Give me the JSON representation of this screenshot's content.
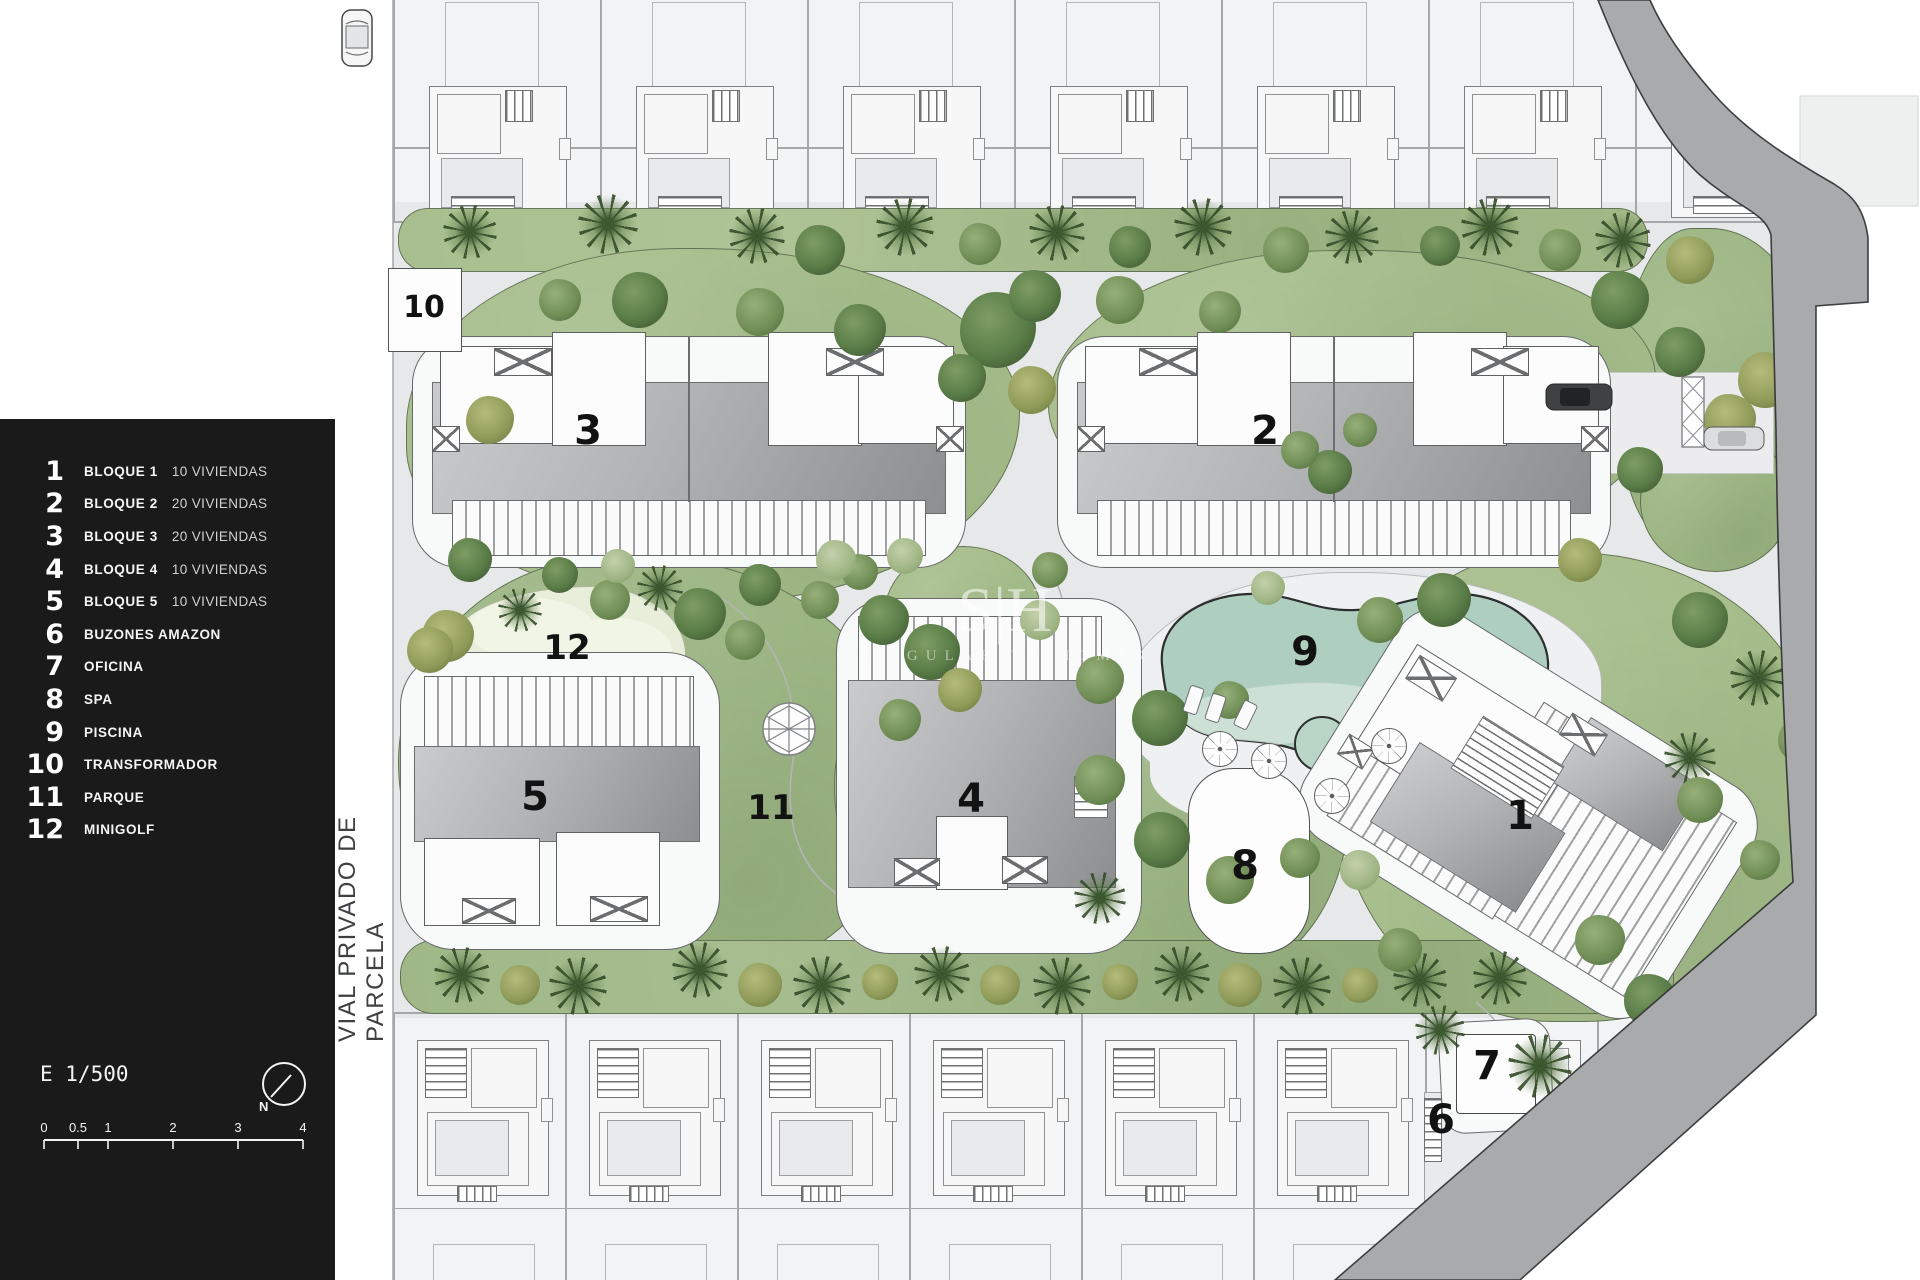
{
  "colors": {
    "panel_bg": "#1a1a1a",
    "road_gray": "#a8aaac",
    "lawn_green": "#a6bd8b",
    "lawn_green_dark": "#9db684",
    "pool_teal": "#aecfc0",
    "plan_gray": "#e7e8ea"
  },
  "legend": {
    "items": [
      {
        "num": "1",
        "label": "BLOQUE 1",
        "detail": "10 VIVIENDAS"
      },
      {
        "num": "2",
        "label": "BLOQUE 2",
        "detail": "20 VIVIENDAS"
      },
      {
        "num": "3",
        "label": "BLOQUE 3",
        "detail": "20 VIVIENDAS"
      },
      {
        "num": "4",
        "label": "BLOQUE 4",
        "detail": "10 VIVIENDAS"
      },
      {
        "num": "5",
        "label": "BLOQUE 5",
        "detail": "10 VIVIENDAS"
      },
      {
        "num": "6",
        "label": "BUZONES AMAZON",
        "detail": ""
      },
      {
        "num": "7",
        "label": "OFICINA",
        "detail": ""
      },
      {
        "num": "8",
        "label": "SPA",
        "detail": ""
      },
      {
        "num": "9",
        "label": "PISCINA",
        "detail": ""
      },
      {
        "num": "10",
        "label": "TRANSFORMADOR",
        "detail": ""
      },
      {
        "num": "11",
        "label": "PARQUE",
        "detail": ""
      },
      {
        "num": "12",
        "label": "MINIGOLF",
        "detail": ""
      }
    ],
    "scale_text": "E 1/500",
    "north_label": "N",
    "scale_bar": {
      "labels": [
        "0",
        "0.5",
        "1",
        "2",
        "3",
        "4"
      ]
    }
  },
  "street_label": "VIAL PRIVADO DE PARCELA",
  "watermark": {
    "monogram": "S|H",
    "name": "SINGULARITY HOMES"
  },
  "map_labels": [
    {
      "n": "10",
      "x": 424,
      "y": 308
    },
    {
      "n": "3",
      "x": 588,
      "y": 431
    },
    {
      "n": "2",
      "x": 1265,
      "y": 431
    },
    {
      "n": "12",
      "x": 567,
      "y": 648
    },
    {
      "n": "9",
      "x": 1305,
      "y": 652
    },
    {
      "n": "5",
      "x": 535,
      "y": 797
    },
    {
      "n": "11",
      "x": 771,
      "y": 808
    },
    {
      "n": "4",
      "x": 971,
      "y": 799
    },
    {
      "n": "8",
      "x": 1245,
      "y": 866
    },
    {
      "n": "1",
      "x": 1520,
      "y": 816
    },
    {
      "n": "7",
      "x": 1487,
      "y": 1066
    },
    {
      "n": "6",
      "x": 1441,
      "y": 1120
    }
  ]
}
